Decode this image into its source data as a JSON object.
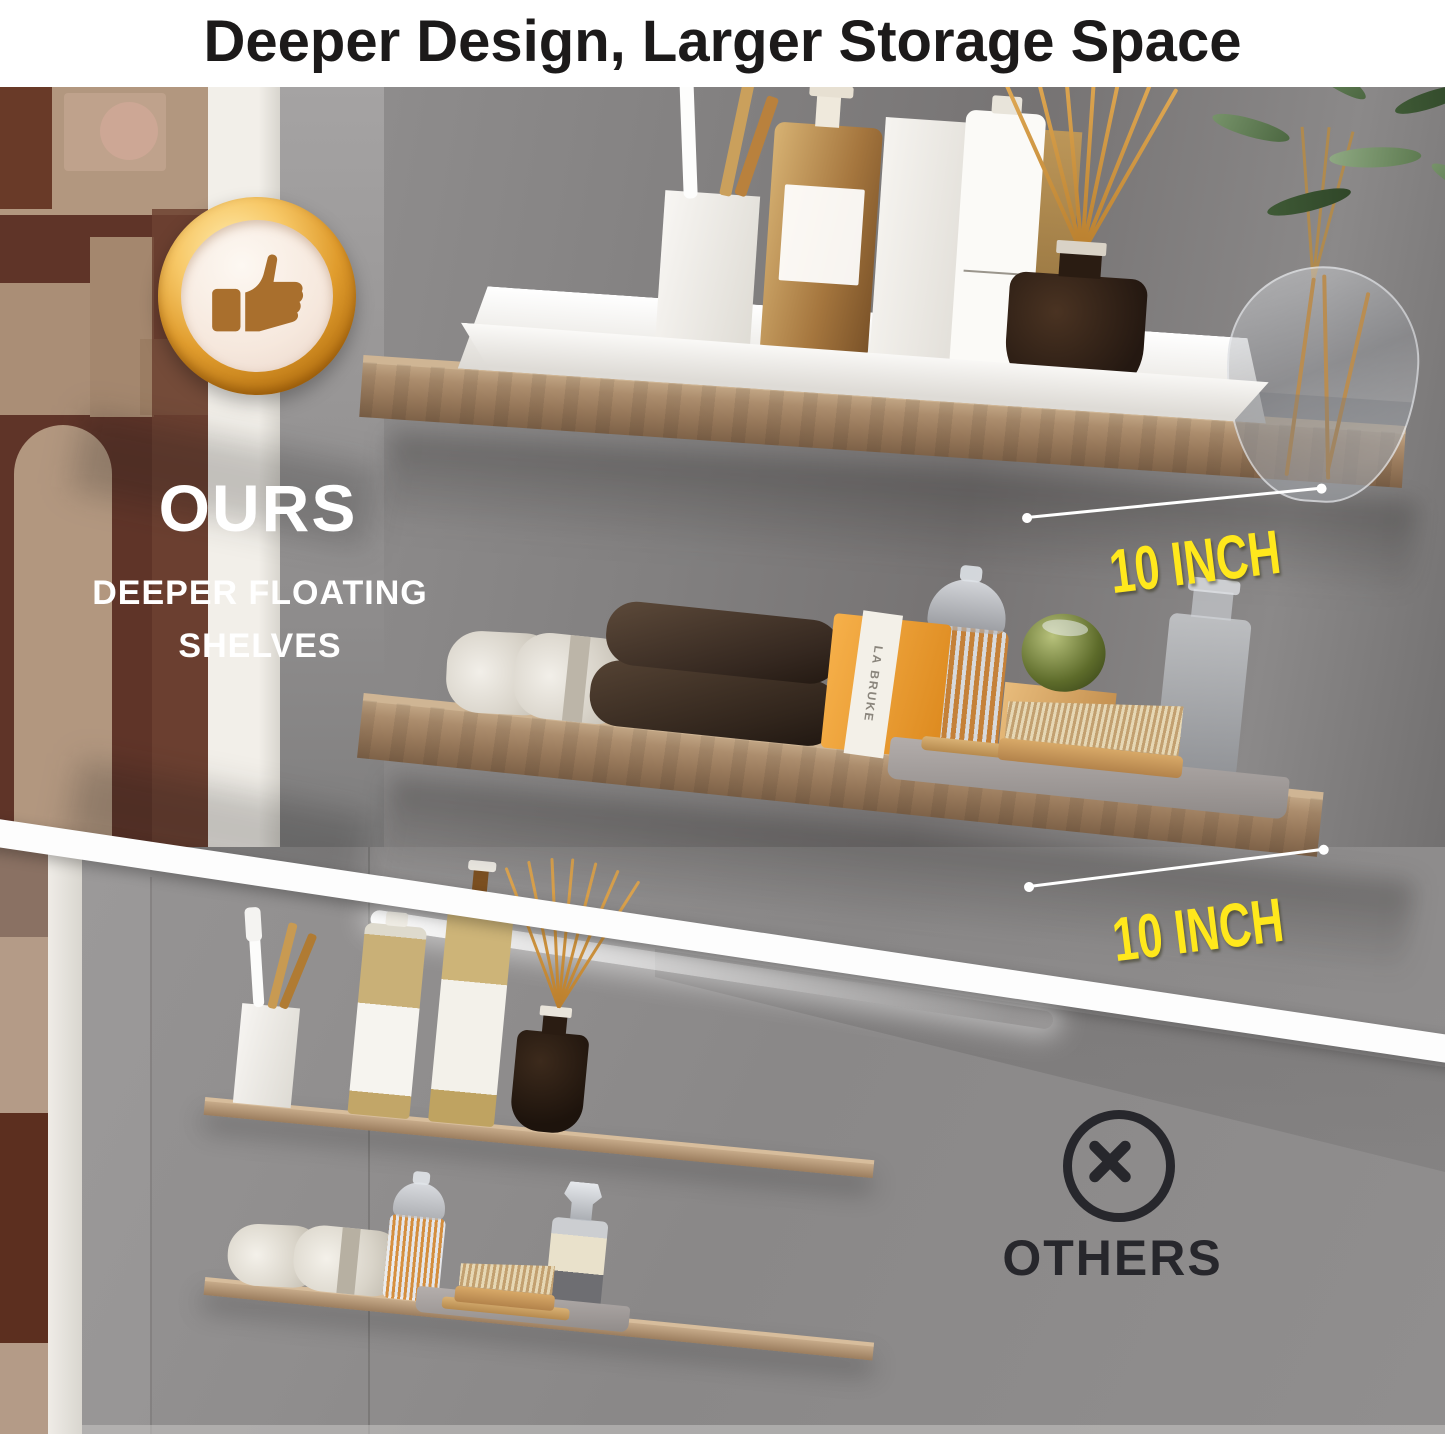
{
  "header": {
    "title": "Deeper Design, Larger Storage Space"
  },
  "ours_section": {
    "badge_icon": "thumbs-up-badge-icon",
    "label": "OURS",
    "subtitle_line1": "DEEPER FLOATING",
    "subtitle_line2": "SHELVES",
    "dimension_labels": {
      "top_shelf": "10 INCH",
      "bottom_shelf": "10 INCH"
    }
  },
  "others_section": {
    "icon": "circle-cross-icon",
    "label": "OTHERS"
  },
  "product_text": {
    "soap_box_brand": "LA BRUKE"
  },
  "colors": {
    "highlight_yellow": "#FFE81C",
    "badge_gold": "#E09C2D",
    "dark_label": "#27272C",
    "wood_tone": "#A8896B",
    "wall_gray": "#8B8989",
    "title_black": "#1C1A1A"
  }
}
